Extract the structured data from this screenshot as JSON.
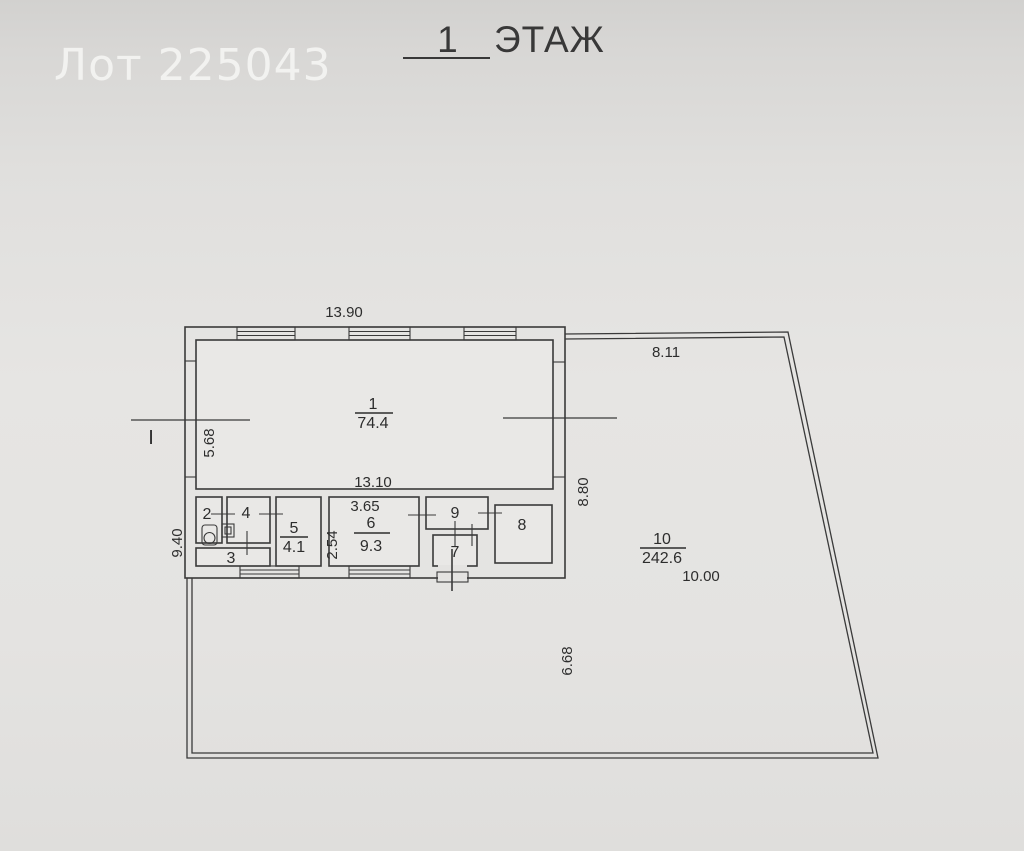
{
  "watermark": {
    "text": "Лот 225043"
  },
  "title": {
    "text": "1 ЭТАЖ"
  },
  "plan": {
    "section_label": "I",
    "rooms": {
      "r1": {
        "number": "1",
        "area": "74.4"
      },
      "r2": {
        "number": "2"
      },
      "r3": {
        "number": "3"
      },
      "r4": {
        "number": "4"
      },
      "r5": {
        "number": "5",
        "area": "4.1"
      },
      "r6": {
        "number": "6",
        "area": "9.3"
      },
      "r7": {
        "number": "7"
      },
      "r8": {
        "number": "8"
      },
      "r9": {
        "number": "9"
      },
      "r10": {
        "number": "10",
        "area": "242.6"
      }
    },
    "dimensions": {
      "building_top_width": "13.90",
      "site_top_width": "8.11",
      "room1_height": "5.68",
      "room1_bottom_width": "13.10",
      "site_right_upper_height": "8.80",
      "left_outer_height": "9.40",
      "room6_height": "2.54",
      "room6_top_width": "3.65",
      "site_left_lower_height": "6.68",
      "site_lower_width": "10.00"
    }
  },
  "colors": {
    "line": "#3a3a3a",
    "text": "#2d2d2d",
    "watermark": "#f4f4f2",
    "room_fill": "#e9e8e6"
  }
}
